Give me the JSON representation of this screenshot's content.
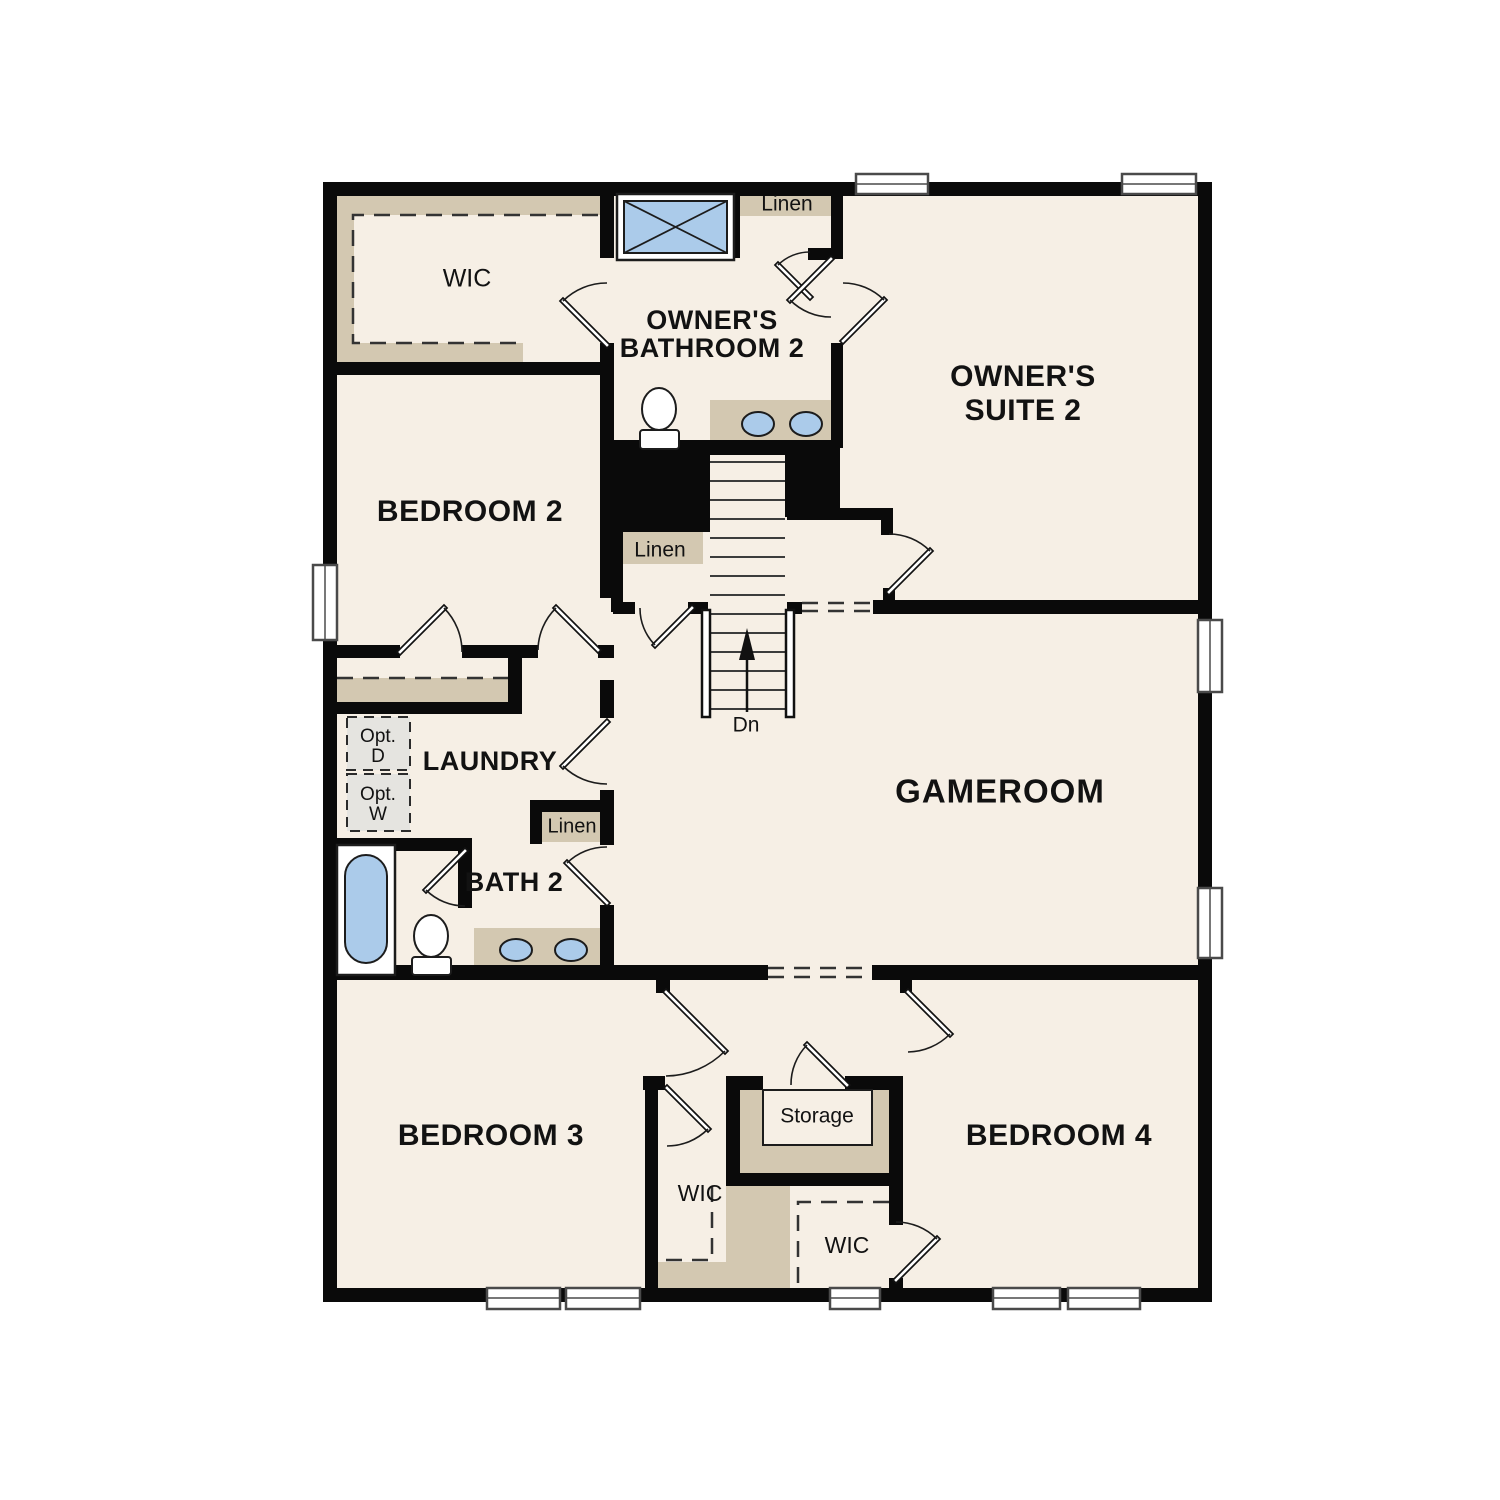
{
  "labels": {
    "wic_top": "WIC",
    "owners_bathroom_line1": "OWNER'S",
    "owners_bathroom_line2": "BATHROOM 2",
    "linen_top": "Linen",
    "owners_suite_line1": "OWNER'S",
    "owners_suite_line2": "SUITE 2",
    "bedroom2": "BEDROOM 2",
    "linen_stairs": "Linen",
    "stairs_direction": "Dn",
    "opt_d_line1": "Opt.",
    "opt_d_line2": "D",
    "opt_w_line1": "Opt.",
    "opt_w_line2": "W",
    "laundry": "LAUNDRY",
    "linen_bath": "Linen",
    "bath2": "BATH 2",
    "gameroom": "GAMEROOM",
    "bedroom3": "BEDROOM 3",
    "storage": "Storage",
    "wic_bedroom3": "WIC",
    "wic_bedroom4": "WIC",
    "bedroom4": "BEDROOM 4"
  },
  "colors": {
    "floor": "#f6efe5",
    "wall": "#0a0a0a",
    "closet_tan": "#d3c8b1",
    "fixture_blue": "#abcbea",
    "option_gray": "#e5e4e0",
    "background": "#ffffff"
  },
  "fixtures": [
    "shower-icon",
    "toilet-icon",
    "sink-icon",
    "bathtub-icon",
    "staircase",
    "washer-option",
    "dryer-option",
    "storage-shelf"
  ]
}
